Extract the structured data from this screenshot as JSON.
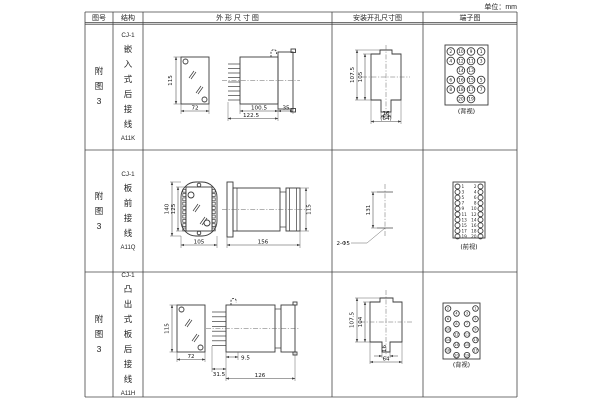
{
  "page": {
    "unit": "单位：mm"
  },
  "header": {
    "fig": "图号",
    "struct": "结构",
    "outline": "外 形 尺 寸 图",
    "install": "安装开孔尺寸图",
    "terminal": "端子图"
  },
  "rows": [
    {
      "fig": "附图3",
      "model": "CJ-1",
      "structure": "嵌入式后接线",
      "code": "A11K",
      "outline": {
        "front_h": "115",
        "front_w": "72",
        "body_len": "100.5",
        "total_len": "122.5",
        "flange": "35"
      },
      "install": {
        "h_outer": "107.5",
        "h_inner": "105",
        "slot_w": "16",
        "cut_w": "(64)"
      },
      "terminal": {
        "view": "(背视)",
        "grid": [
          [
            "2",
            "10",
            "9",
            "1"
          ],
          [
            "4",
            "12",
            "11",
            "3"
          ],
          [
            "",
            "14",
            "13",
            ""
          ],
          [
            "6",
            "16",
            "15",
            "5"
          ],
          [
            "8",
            "18",
            "17",
            "7"
          ],
          [
            "",
            "20",
            "19",
            ""
          ]
        ]
      }
    },
    {
      "fig": "附图3",
      "model": "CJ-1",
      "structure": "板前接线",
      "code": "A11Q",
      "outline": {
        "front_h_outer": "140",
        "front_h_inner": "125",
        "front_w": "105",
        "side_len": "156",
        "side_h": "115"
      },
      "install": {
        "hole_spacing": "131",
        "holes": "2-Φ5"
      },
      "terminal": {
        "view": "(前视)",
        "pairs": [
          [
            "1",
            "2"
          ],
          [
            "3",
            "4"
          ],
          [
            "5",
            "6"
          ],
          [
            "7",
            "8"
          ],
          [
            "9",
            "10"
          ],
          [
            "11",
            "12"
          ],
          [
            "13",
            "14"
          ],
          [
            "15",
            "16"
          ],
          [
            "17",
            "18"
          ],
          [
            "19",
            "20"
          ]
        ]
      }
    },
    {
      "fig": "附图3",
      "model": "CJ-1",
      "structure": "凸出式板后接线",
      "code": "A11H",
      "outline": {
        "front_h": "115",
        "front_w": "72",
        "comb_len": "31.5",
        "pin_len": "9.5",
        "total_len": "126"
      },
      "install": {
        "h_outer": "107.5",
        "h_inner": "104",
        "slot_w": "16",
        "cut_w": "64"
      },
      "terminal": {
        "view": "(背视)",
        "outer_left": [
          "2",
          "6",
          "10",
          "14",
          "18"
        ],
        "inner_left": [
          "4",
          "8",
          "12",
          "16",
          "20"
        ],
        "inner_right": [
          "3",
          "7",
          "11",
          "15",
          "19"
        ],
        "outer_right": [
          "1",
          "5",
          "9",
          "13",
          "17"
        ]
      }
    }
  ]
}
